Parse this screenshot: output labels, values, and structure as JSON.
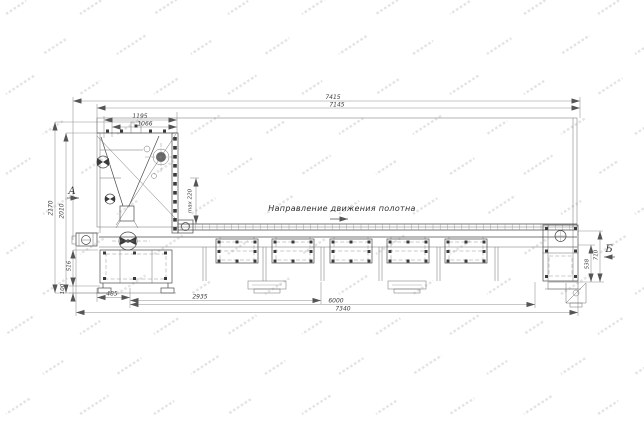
{
  "drawing": {
    "direction_label": "Направление движения полотна",
    "view_a_label": "А",
    "view_b_label": "Б",
    "dims": {
      "top_overall": "7415",
      "top_frame": "7145",
      "hopper_outer": "1195",
      "hopper_inner": "1066",
      "height_overall": "2170",
      "height_frame": "2010",
      "max_gap": "max 220",
      "left_table_height": "516",
      "left_foot_height": "100",
      "bottom_first": "485",
      "bottom_second": "2935",
      "bottom_frame_length": "6000",
      "bottom_overall_length": "7340",
      "right_height_outer": "710",
      "right_height_inner": "538"
    }
  }
}
